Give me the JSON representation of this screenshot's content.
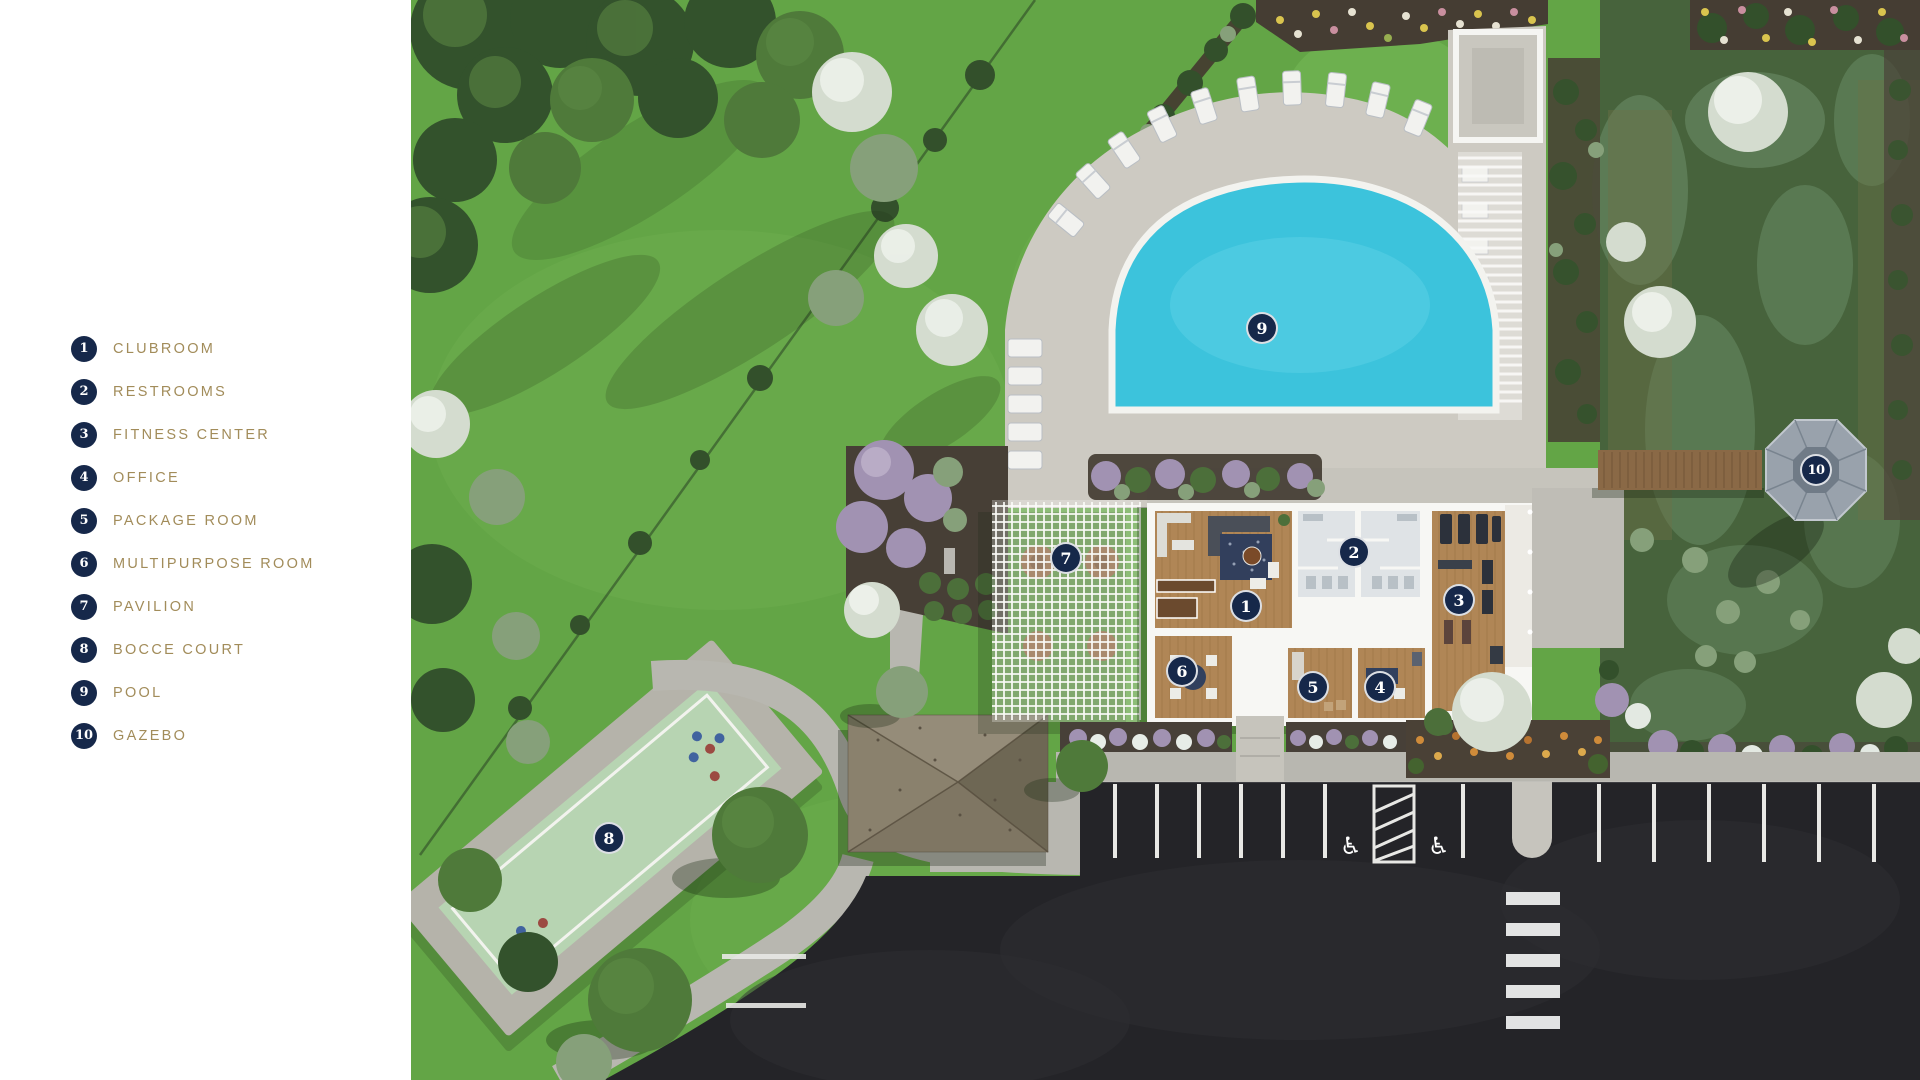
{
  "palette": {
    "marker_navy": "#16284a",
    "legend_gold": "#a28c5a",
    "panel_white": "#ffffff",
    "lawn_green": "#63a546",
    "pool_water": "#3cc3dc",
    "asphalt": "#242428"
  },
  "legend": {
    "items": [
      {
        "number": "1",
        "label": "CLUBROOM"
      },
      {
        "number": "2",
        "label": "RESTROOMS"
      },
      {
        "number": "3",
        "label": "FITNESS CENTER"
      },
      {
        "number": "4",
        "label": "OFFICE"
      },
      {
        "number": "5",
        "label": "PACKAGE ROOM"
      },
      {
        "number": "6",
        "label": "MULTIPURPOSE ROOM"
      },
      {
        "number": "7",
        "label": "PAVILION"
      },
      {
        "number": "8",
        "label": "BOCCE COURT"
      },
      {
        "number": "9",
        "label": "POOL"
      },
      {
        "number": "10",
        "label": "GAZEBO"
      }
    ]
  },
  "icons": {
    "accessible_parking": "♿"
  }
}
